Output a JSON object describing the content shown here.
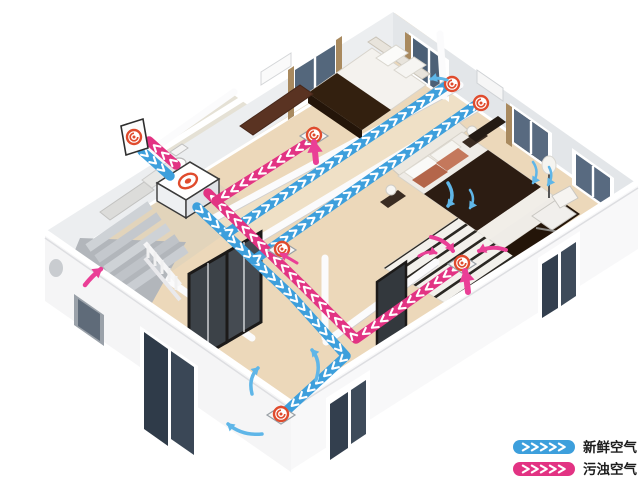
{
  "diagram_title": "home-fresh-air-ventilation-system",
  "legend": {
    "items": [
      {
        "id": "fresh",
        "label": "新鲜空气",
        "color": "#3d9fdc"
      },
      {
        "id": "exhaust",
        "label": "污浊空气",
        "color": "#e23383"
      }
    ]
  },
  "colors": {
    "fresh_duct": "#3d9fdc",
    "exhaust_duct": "#e23383",
    "fresh_flow": "#5fb6e8",
    "exhaust_flow": "#ea3f96",
    "vent_ring": "#e04b2d",
    "chevron": "#ffffff"
  },
  "unit": {
    "name": "ventilation-unit",
    "x": 188,
    "y": 181
  },
  "ducts": [
    {
      "name": "fresh-air-intake",
      "type": "fresh",
      "points": [
        [
          142,
          151
        ],
        [
          170,
          176
        ]
      ]
    },
    {
      "name": "fresh-air-trunk",
      "type": "fresh",
      "points": [
        [
          197,
          207
        ],
        [
          292,
          296
        ],
        [
          346,
          356
        ],
        [
          284,
          413
        ]
      ]
    },
    {
      "name": "fresh-air-branch-bedroom1",
      "type": "fresh",
      "points": [
        [
          226,
          234
        ],
        [
          446,
          86
        ]
      ]
    },
    {
      "name": "fresh-air-branch-master",
      "type": "fresh",
      "points": [
        [
          254,
          260
        ],
        [
          477,
          104
        ]
      ]
    },
    {
      "name": "exhaust-air-outlet",
      "type": "exhaust",
      "points": [
        [
          176,
          165
        ],
        [
          149,
          141
        ]
      ]
    },
    {
      "name": "exhaust-air-trunk",
      "type": "exhaust",
      "points": [
        [
          459,
          266
        ],
        [
          356,
          339
        ],
        [
          303,
          286
        ],
        [
          208,
          193
        ]
      ]
    },
    {
      "name": "exhaust-air-branch-corridor",
      "type": "exhaust",
      "points": [
        [
          312,
          140
        ],
        [
          216,
          201
        ]
      ]
    }
  ],
  "vents": [
    {
      "name": "outdoor-wall-vent",
      "kind": "outdoor",
      "x": 134,
      "y": 137
    },
    {
      "name": "supply-diffuser-bedroom1",
      "kind": "supply",
      "x": 452,
      "y": 84
    },
    {
      "name": "supply-diffuser-master-bedroom",
      "kind": "supply",
      "x": 481,
      "y": 103
    },
    {
      "name": "exhaust-grille-master-bedroom",
      "kind": "exhaust",
      "x": 462,
      "y": 263,
      "plate": true
    },
    {
      "name": "supply-diffuser-living-room",
      "kind": "supply",
      "x": 281,
      "y": 414,
      "plate": true
    },
    {
      "name": "exhaust-grille-corridor",
      "kind": "exhaust",
      "x": 314,
      "y": 135,
      "plate": true
    },
    {
      "name": "exhaust-grille-hallway",
      "kind": "exhaust",
      "x": 282,
      "y": 249,
      "plate": true
    }
  ],
  "flow_arrows": [
    {
      "name": "living-room-airflow-up",
      "type": "fresh",
      "width": 3.5,
      "pts": [
        [
          252,
          394
        ],
        [
          248,
          378
        ],
        [
          258,
          368
        ]
      ]
    },
    {
      "name": "living-room-airflow-up2",
      "type": "fresh",
      "width": 3.5,
      "pts": [
        [
          316,
          380
        ],
        [
          322,
          362
        ],
        [
          312,
          350
        ]
      ]
    },
    {
      "name": "living-room-airflow-left",
      "type": "fresh",
      "width": 3.5,
      "pts": [
        [
          262,
          434
        ],
        [
          242,
          436
        ],
        [
          228,
          424
        ]
      ]
    },
    {
      "name": "master-airflow-down",
      "type": "fresh",
      "width": 3.5,
      "pts": [
        [
          448,
          183
        ],
        [
          456,
          196
        ],
        [
          448,
          206
        ]
      ]
    },
    {
      "name": "master-airflow-down2",
      "type": "fresh",
      "width": 2.5,
      "pts": [
        [
          470,
          190
        ],
        [
          476,
          199
        ],
        [
          470,
          208
        ]
      ]
    },
    {
      "name": "master-airflow-lamp1",
      "type": "fresh",
      "width": 2.5,
      "pts": [
        [
          533,
          162
        ],
        [
          540,
          172
        ],
        [
          533,
          183
        ]
      ]
    },
    {
      "name": "master-airflow-lamp2",
      "type": "fresh",
      "width": 2.5,
      "pts": [
        [
          549,
          167
        ],
        [
          554,
          176
        ],
        [
          548,
          185
        ]
      ]
    },
    {
      "name": "bedroom1-airflow-in",
      "type": "fresh",
      "width": 3,
      "pts": [
        [
          447,
          80
        ],
        [
          439,
          77
        ],
        [
          431,
          79
        ]
      ]
    },
    {
      "name": "master-exhaust-up",
      "type": "exhaust",
      "width": 6,
      "pts": [
        [
          468,
          292
        ],
        [
          467,
          281
        ],
        [
          465,
          271
        ]
      ]
    },
    {
      "name": "master-exhaust-left",
      "type": "exhaust",
      "width": 4,
      "pts": [
        [
          506,
          250
        ],
        [
          492,
          245
        ],
        [
          479,
          251
        ]
      ]
    },
    {
      "name": "master-exhaust-curve",
      "type": "exhaust",
      "width": 4,
      "pts": [
        [
          431,
          237
        ],
        [
          446,
          240
        ],
        [
          453,
          251
        ]
      ]
    },
    {
      "name": "master-exhaust-rug",
      "type": "exhaust",
      "width": 3,
      "pts": [
        [
          419,
          256
        ],
        [
          428,
          250
        ],
        [
          436,
          253
        ]
      ]
    },
    {
      "name": "corridor-exhaust-up",
      "type": "exhaust",
      "width": 6,
      "pts": [
        [
          316,
          162
        ],
        [
          315,
          152
        ],
        [
          314,
          142
        ]
      ]
    },
    {
      "name": "stair-exhaust-up",
      "type": "exhaust",
      "width": 4.5,
      "pts": [
        [
          85,
          285
        ],
        [
          92,
          276
        ],
        [
          101,
          269
        ]
      ]
    },
    {
      "name": "hallway-exhaust-in",
      "type": "exhaust",
      "width": 3,
      "pts": [
        [
          297,
          263
        ],
        [
          289,
          258
        ],
        [
          281,
          254
        ]
      ]
    }
  ]
}
